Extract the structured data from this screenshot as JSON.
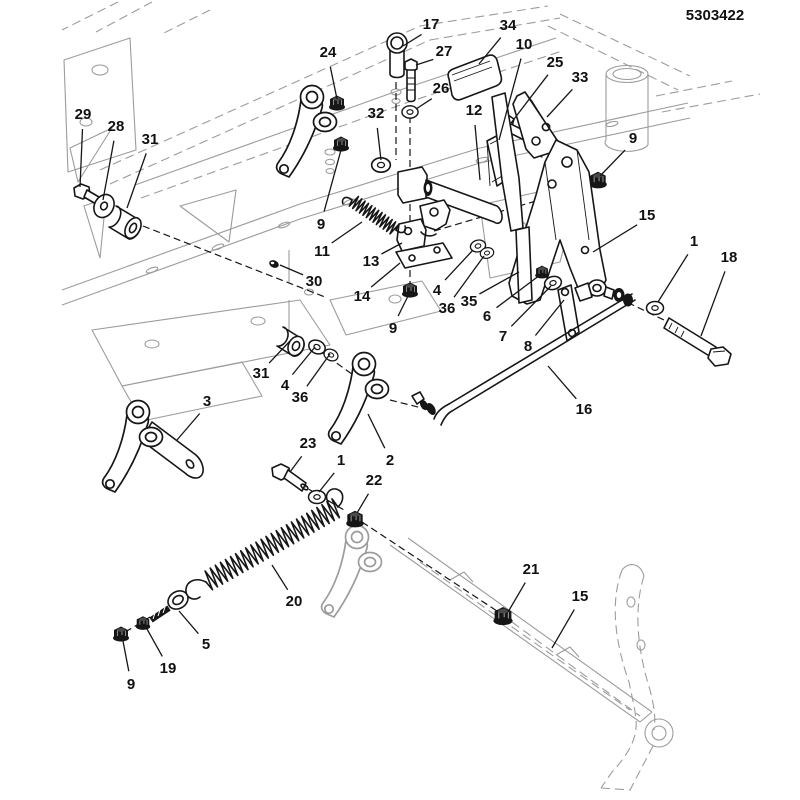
{
  "page": {
    "width": 800,
    "height": 800
  },
  "header": {
    "part_number": "5303422"
  },
  "colors": {
    "line": "#161616",
    "ghost": "#9c9c9c",
    "label": "#111111",
    "background": "#ffffff"
  },
  "callouts": [
    {
      "label": "17",
      "x": 431,
      "y": 24,
      "tx": 403,
      "ty": 46
    },
    {
      "label": "34",
      "x": 508,
      "y": 25,
      "tx": 479,
      "ty": 64
    },
    {
      "label": "10",
      "x": 524,
      "y": 44,
      "tx": 499,
      "ty": 140
    },
    {
      "label": "24",
      "x": 328,
      "y": 52,
      "tx": 337,
      "ty": 99
    },
    {
      "label": "27",
      "x": 444,
      "y": 51,
      "tx": 416,
      "ty": 65
    },
    {
      "label": "25",
      "x": 555,
      "y": 62,
      "tx": 511,
      "ty": 123
    },
    {
      "label": "33",
      "x": 580,
      "y": 77,
      "tx": 547,
      "ty": 117
    },
    {
      "label": "26",
      "x": 441,
      "y": 88,
      "tx": 416,
      "ty": 109
    },
    {
      "label": "32",
      "x": 376,
      "y": 113,
      "tx": 381,
      "ty": 160
    },
    {
      "label": "29",
      "x": 83,
      "y": 114,
      "tx": 80,
      "ty": 187
    },
    {
      "label": "28",
      "x": 116,
      "y": 126,
      "tx": 103,
      "ty": 200
    },
    {
      "label": "31",
      "x": 150,
      "y": 139,
      "tx": 127,
      "ty": 208
    },
    {
      "label": "12",
      "x": 474,
      "y": 110,
      "tx": 480,
      "ty": 180
    },
    {
      "label": "9",
      "x": 633,
      "y": 138,
      "tx": 600,
      "ty": 176
    },
    {
      "label": "15",
      "x": 647,
      "y": 215,
      "tx": 593,
      "ty": 252
    },
    {
      "label": "9",
      "x": 321,
      "y": 224,
      "tx": 341,
      "ty": 150
    },
    {
      "label": "1",
      "x": 694,
      "y": 241,
      "tx": 658,
      "ty": 302
    },
    {
      "label": "18",
      "x": 729,
      "y": 257,
      "tx": 701,
      "ty": 336
    },
    {
      "label": "11",
      "x": 322,
      "y": 251,
      "tx": 362,
      "ty": 222
    },
    {
      "label": "13",
      "x": 371,
      "y": 261,
      "tx": 402,
      "ty": 243
    },
    {
      "label": "30",
      "x": 314,
      "y": 281,
      "tx": 280,
      "ty": 265
    },
    {
      "label": "14",
      "x": 362,
      "y": 296,
      "tx": 400,
      "ty": 263
    },
    {
      "label": "4",
      "x": 437,
      "y": 290,
      "tx": 473,
      "ty": 250
    },
    {
      "label": "35",
      "x": 469,
      "y": 301,
      "tx": 519,
      "ty": 272
    },
    {
      "label": "36",
      "x": 447,
      "y": 308,
      "tx": 484,
      "ty": 256
    },
    {
      "label": "6",
      "x": 487,
      "y": 316,
      "tx": 540,
      "ty": 275
    },
    {
      "label": "9",
      "x": 393,
      "y": 328,
      "tx": 409,
      "ty": 294
    },
    {
      "label": "7",
      "x": 503,
      "y": 336,
      "tx": 551,
      "ty": 286
    },
    {
      "label": "8",
      "x": 528,
      "y": 346,
      "tx": 564,
      "ty": 300
    },
    {
      "label": "31",
      "x": 261,
      "y": 373,
      "tx": 290,
      "ty": 341
    },
    {
      "label": "4",
      "x": 285,
      "y": 385,
      "tx": 315,
      "ty": 347
    },
    {
      "label": "36",
      "x": 300,
      "y": 397,
      "tx": 330,
      "ty": 354
    },
    {
      "label": "3",
      "x": 207,
      "y": 401,
      "tx": 177,
      "ty": 440
    },
    {
      "label": "16",
      "x": 584,
      "y": 409,
      "tx": 548,
      "ty": 366
    },
    {
      "label": "23",
      "x": 308,
      "y": 443,
      "tx": 290,
      "ty": 472
    },
    {
      "label": "1",
      "x": 341,
      "y": 460,
      "tx": 319,
      "ty": 492
    },
    {
      "label": "2",
      "x": 390,
      "y": 460,
      "tx": 368,
      "ty": 414
    },
    {
      "label": "22",
      "x": 374,
      "y": 480,
      "tx": 357,
      "ty": 513
    },
    {
      "label": "21",
      "x": 531,
      "y": 569,
      "tx": 508,
      "ty": 612
    },
    {
      "label": "15",
      "x": 580,
      "y": 596,
      "tx": 552,
      "ty": 648
    },
    {
      "label": "20",
      "x": 294,
      "y": 601,
      "tx": 272,
      "ty": 565
    },
    {
      "label": "5",
      "x": 206,
      "y": 644,
      "tx": 179,
      "ty": 611
    },
    {
      "label": "19",
      "x": 168,
      "y": 668,
      "tx": 147,
      "ty": 629
    },
    {
      "label": "9",
      "x": 131,
      "y": 684,
      "tx": 123,
      "ty": 641
    }
  ]
}
